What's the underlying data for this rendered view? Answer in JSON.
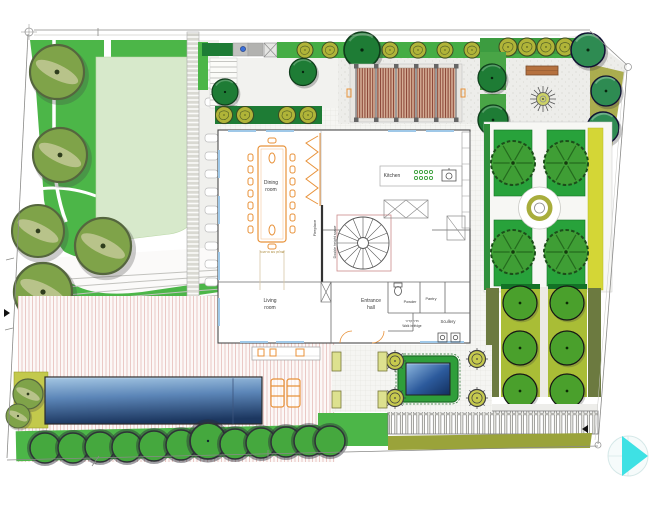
{
  "plan": {
    "rooms": {
      "dining": {
        "line1": "Dining",
        "line2": "room"
      },
      "kitchen": {
        "label": "Kitchen"
      },
      "living": {
        "line1": "Living",
        "line2": "room"
      },
      "entrance_hall": {
        "line1": "Entrance",
        "line2": "hall"
      },
      "powder": {
        "label": "Powder"
      },
      "pantry": {
        "label": "Pantry"
      },
      "scullery": {
        "label": "Scullery"
      },
      "walk_in_fridge": {
        "label_he": "חדר קירור",
        "label": "Walk in fridge"
      },
      "fireplace": {
        "label": "Fireplace"
      },
      "double_height": {
        "label": "Double height space"
      }
    },
    "notes": {
      "dining_table_he": "שולחן עם הרחבה",
      "dimension_mark": "2"
    },
    "features": {
      "pool": "swimming pool",
      "deck": "wood deck",
      "pergola": "pergola",
      "bench": "bench",
      "palm": "palm tree",
      "lawn": "lawn",
      "formal_garden": "formal parterre garden with fountain",
      "orchard": "orchard rows",
      "water_feature": "entrance water feature",
      "north_arrow": "north arrow / view control"
    },
    "colors": {
      "lawn_light": "#d7e9cb",
      "grass_bright": "#4cb648",
      "formal_grass": "#28a23b",
      "tree_olive": "#7fa349",
      "tree_dark_green": "#1e7c35",
      "tree_teal": "#2e8b52",
      "tree_orchard": "#4aa02c",
      "orchard_bed": "#a9bd36",
      "yellow_strip": "#d4d636",
      "hedge_olive": "#6c7a40",
      "pool_dark": "#1e3a64",
      "pool_light": "#9fc3e2",
      "deck_stripe": "#ecc9c6",
      "pergola_slat": "#8a4536",
      "bench_brown": "#b5713f",
      "furniture_orange": "#e8923a",
      "window_blue": "#9fc8e8",
      "north_arrow_cyan": "#3ee1e4"
    }
  }
}
